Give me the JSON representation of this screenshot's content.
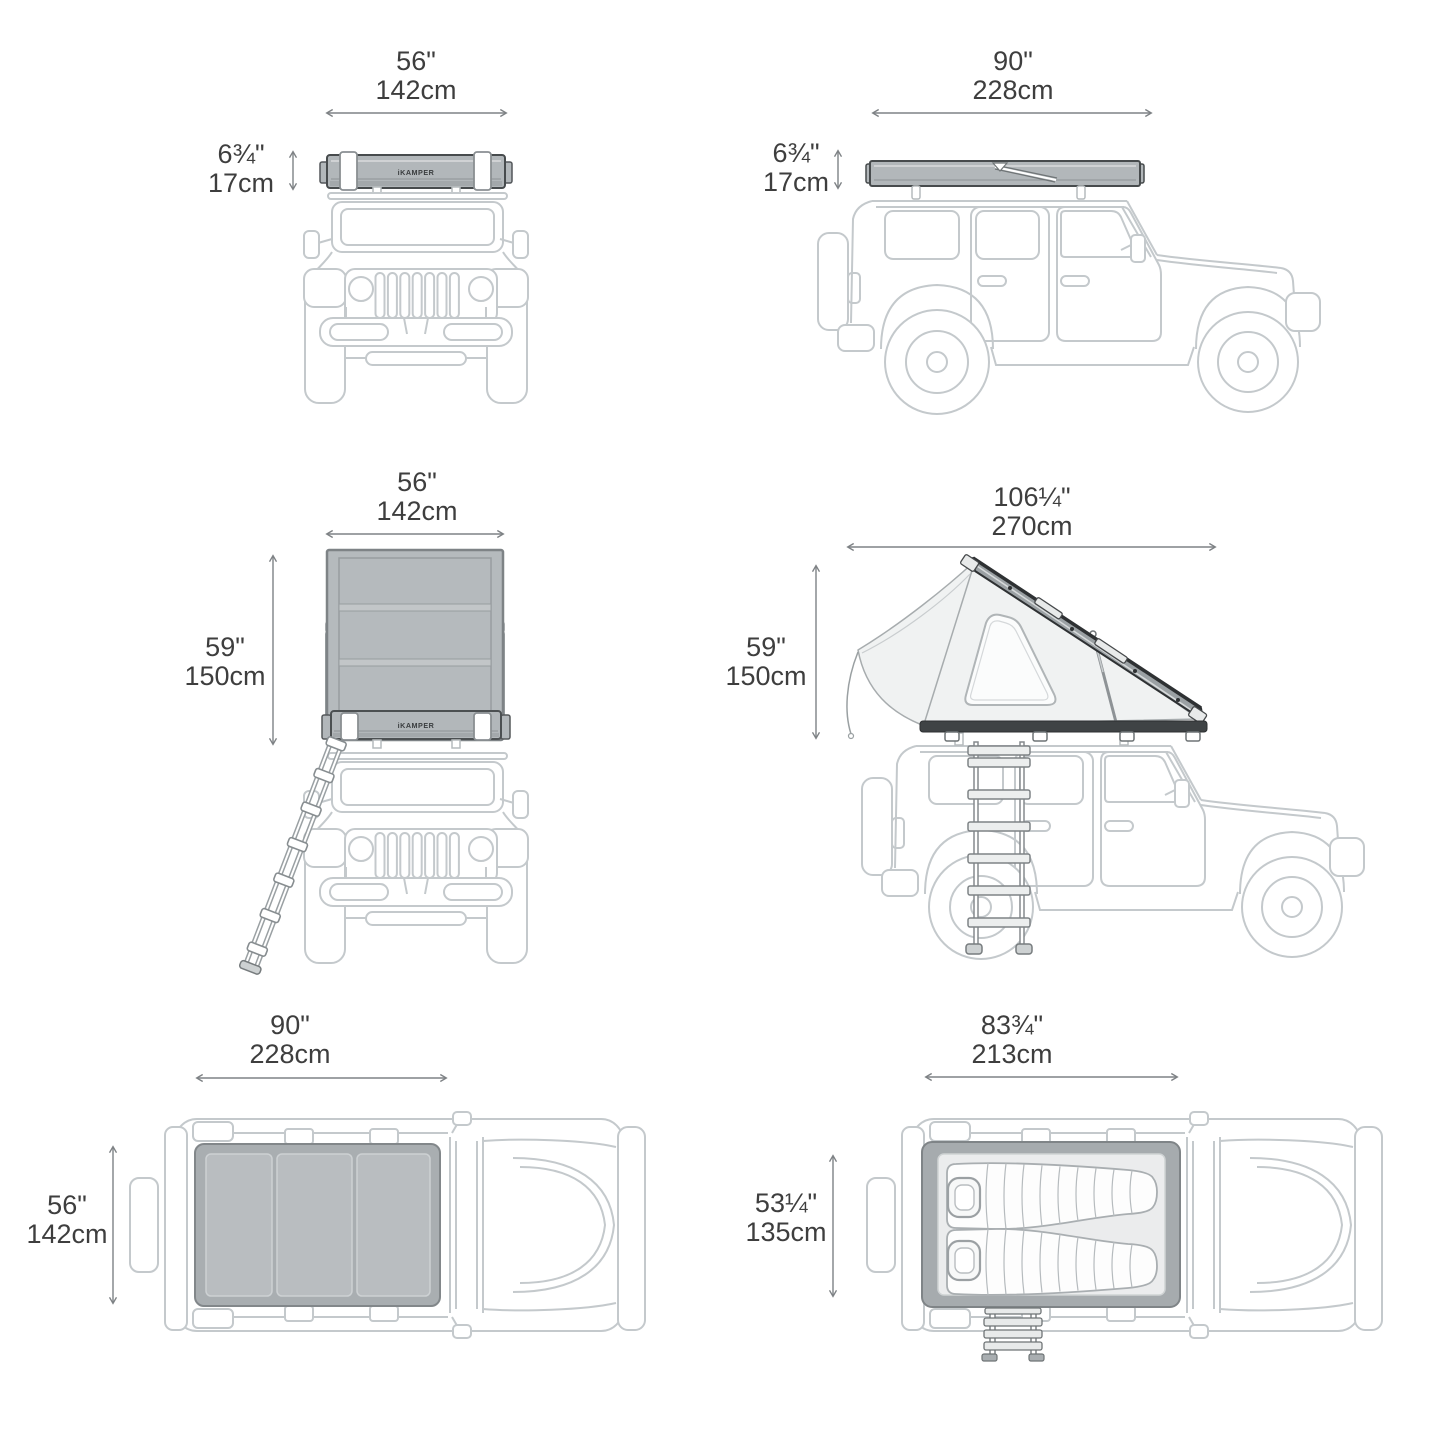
{
  "brand": "iKAMPER",
  "views": [
    {
      "name": "front-view-tent-closed",
      "width_in": "56\"",
      "width_cm": "142cm",
      "height_in": "6¾\"",
      "height_cm": "17cm"
    },
    {
      "name": "side-view-tent-closed",
      "width_in": "90\"",
      "width_cm": "228cm",
      "height_in": "6¾\"",
      "height_cm": "17cm"
    },
    {
      "name": "front-view-tent-open",
      "width_in": "56\"",
      "width_cm": "142cm",
      "height_in": "59\"",
      "height_cm": "150cm"
    },
    {
      "name": "side-view-tent-open",
      "width_in": "106¼\"",
      "width_cm": "270cm",
      "height_in": "59\"",
      "height_cm": "150cm"
    },
    {
      "name": "top-view-tent-closed",
      "width_in": "90\"",
      "width_cm": "228cm",
      "height_in": "56\"",
      "height_cm": "142cm"
    },
    {
      "name": "top-view-tent-open",
      "width_in": "83¾\"",
      "width_cm": "213cm",
      "height_in": "53¼\"",
      "height_cm": "135cm"
    }
  ],
  "colors": {
    "background": "#ffffff",
    "vehicle_line_art": "#c4c9cc",
    "dimension_text": "#3e3e3e",
    "dimension_arrow": "#7e8285",
    "tent_gray": "#b2b7ba",
    "tent_dark_outline": "#474b4d",
    "tent_roof_dark": "#2e3133",
    "mattress_light": "#ebeced"
  }
}
